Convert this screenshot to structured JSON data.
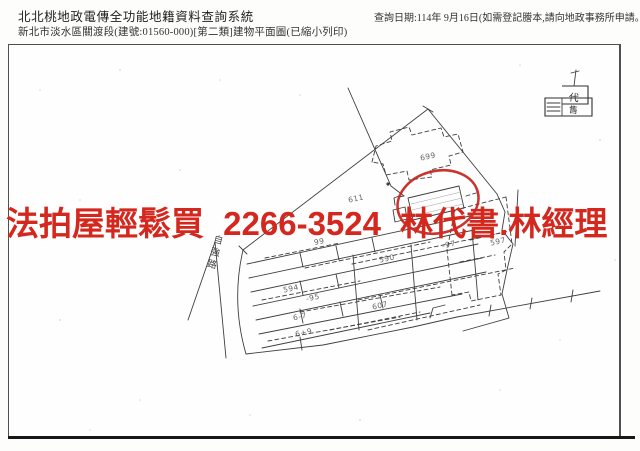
{
  "header": {
    "system_title": "北北桃地政電傳全功能地籍資料查詢系統",
    "document_title": "新北市淡水區關渡段(建號:01560-000)[第二類]建物平面圖(已縮小列印)",
    "query_date_note": "查詢日期:114年 9月16日(如需登記謄本,請向地政事務所申請。)"
  },
  "watermark": {
    "text": "法拍屋輕鬆買 2266-3524 林代書.林經理",
    "color": "#d4281f"
  },
  "plan": {
    "road_label": "自強路",
    "stamp": {
      "top": "代",
      "bottom": "售"
    },
    "labels": [
      "699",
      "611",
      "99",
      "594",
      "-95",
      "6-7",
      "6+9",
      "590",
      "607",
      "-97",
      "597"
    ],
    "ink_color": "#3f3f3f",
    "highlight_color": "#c4231b"
  }
}
